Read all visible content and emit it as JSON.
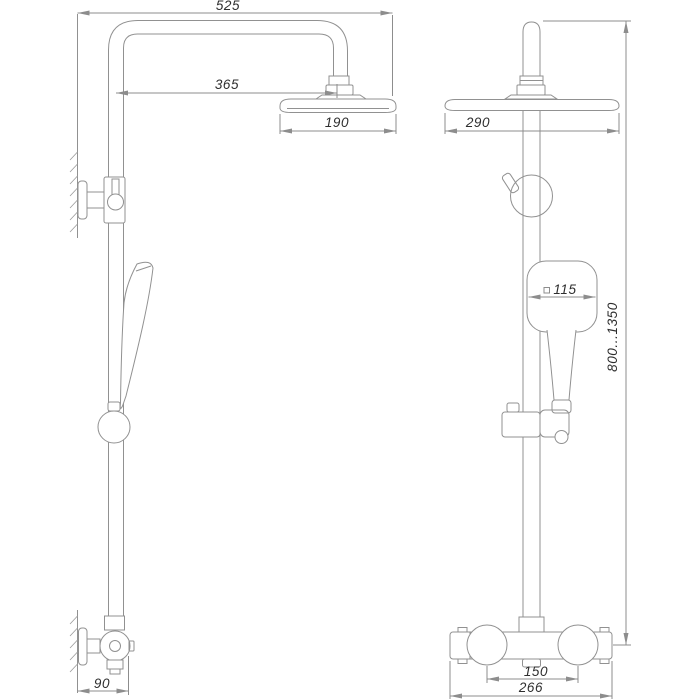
{
  "drawing": {
    "type": "technical-dimension-drawing",
    "subject": "shower-column-system",
    "colors": {
      "background": "#ffffff",
      "line": "#919191",
      "text": "#2e2e2e"
    },
    "views": {
      "side": {
        "label": "side-view",
        "dims": {
          "overall_width": "525",
          "arm_reach": "365",
          "head_depth": "190",
          "wall_offset": "90"
        }
      },
      "front": {
        "label": "front-view",
        "dims": {
          "head_width": "290",
          "hand_shower_width": "115",
          "height_range": "800...1350",
          "handle_spacing": "150",
          "mixer_width": "266"
        }
      }
    }
  }
}
